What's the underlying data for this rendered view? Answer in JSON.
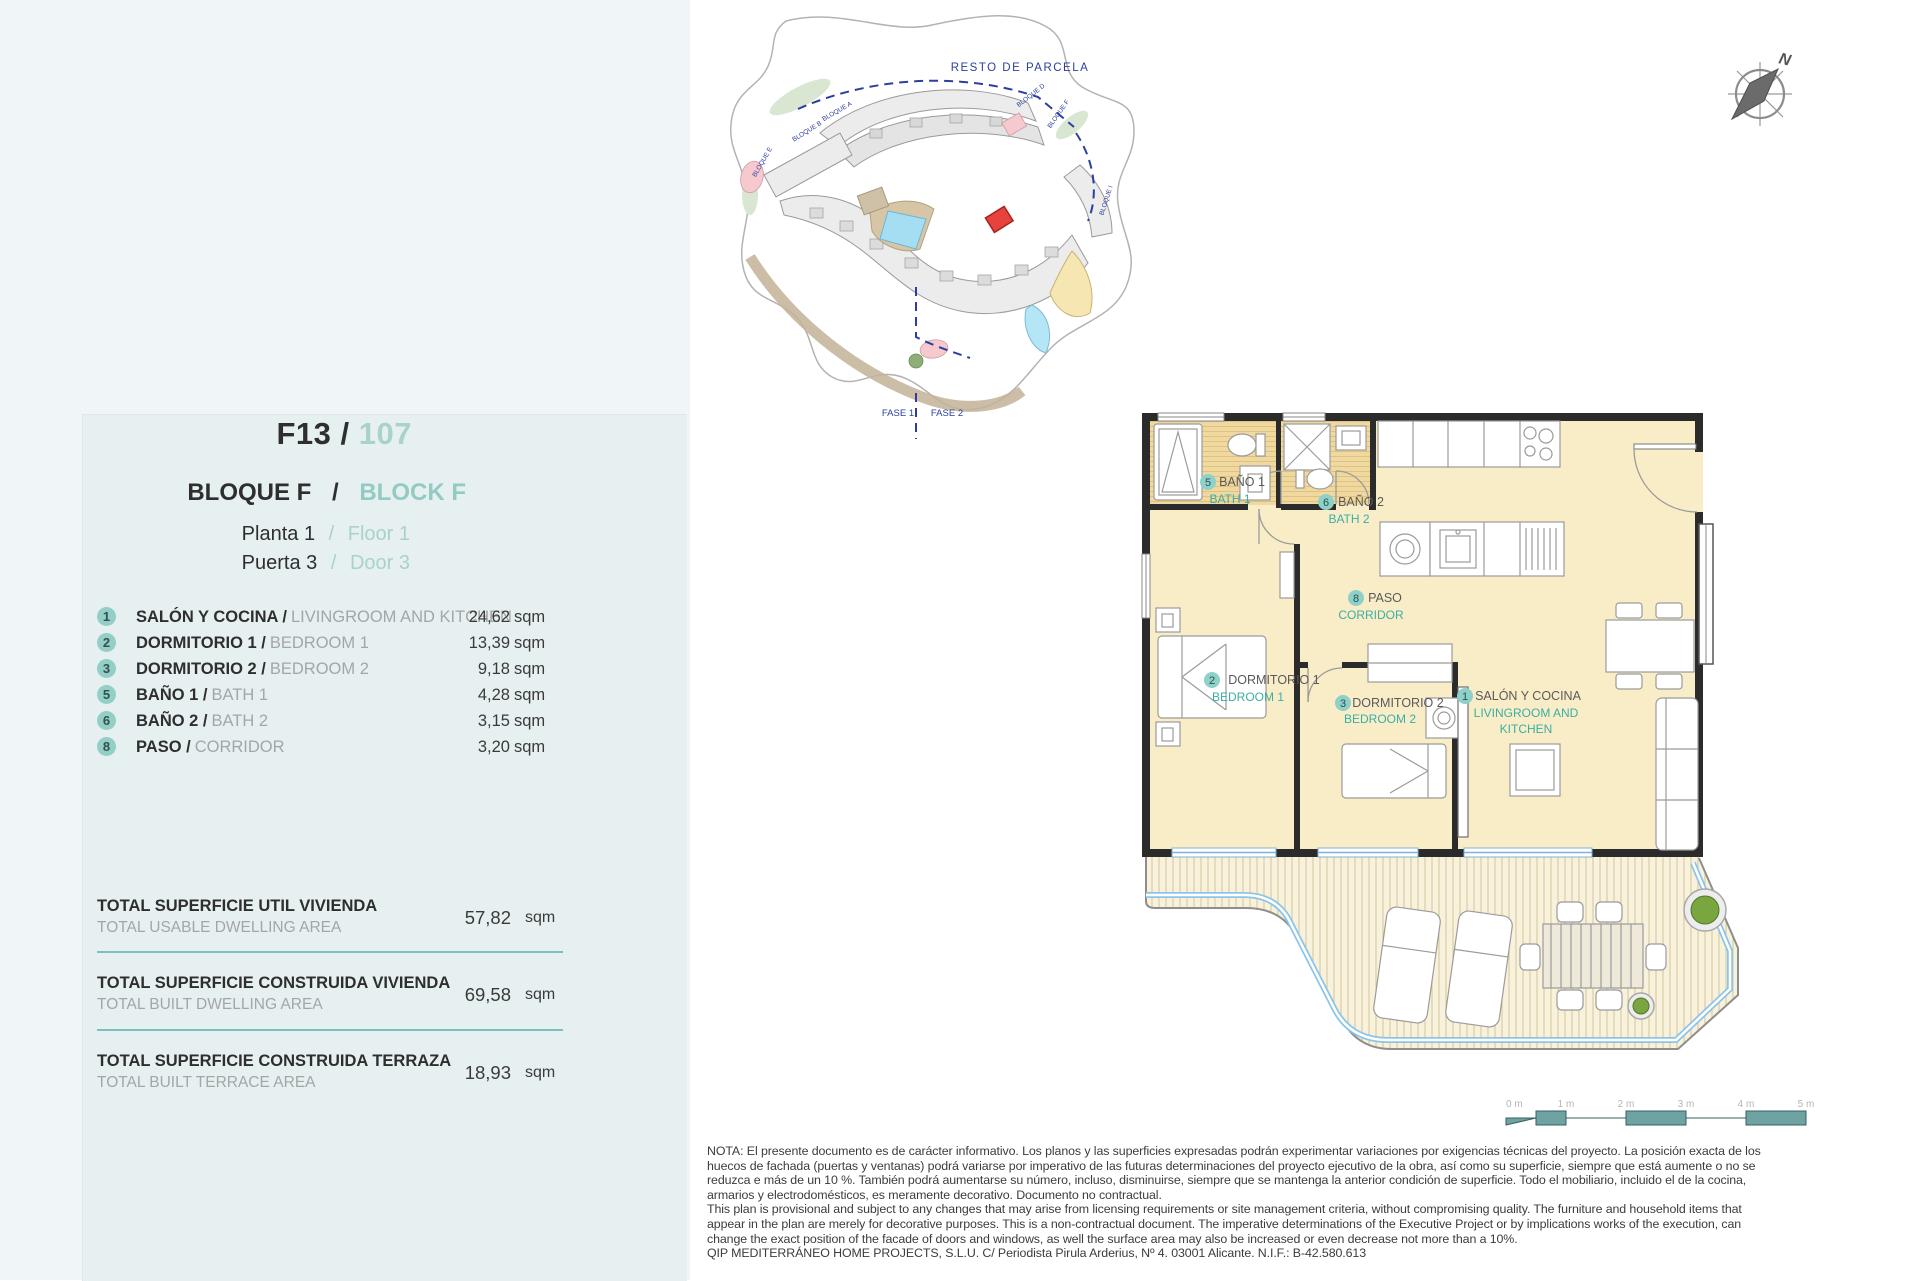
{
  "panel": {
    "unit_code": "F13 /",
    "unit_number": "107",
    "block_es": "BLOQUE F",
    "block_sep": "/",
    "block_en": "BLOCK F",
    "floor_es": "Planta 1",
    "floor_sep": "/",
    "floor_en": "Floor 1",
    "door_es": "Puerta 3",
    "door_sep": "/",
    "door_en": "Door 3"
  },
  "rooms": [
    {
      "num": "1",
      "name_es": "SALÓN Y COCINA /",
      "name_en": "LIVINGROOM AND KITCHEN",
      "area": "24,62",
      "unit": "sqm"
    },
    {
      "num": "2",
      "name_es": "DORMITORIO 1 /",
      "name_en": "BEDROOM 1",
      "area": "13,39",
      "unit": "sqm"
    },
    {
      "num": "3",
      "name_es": "DORMITORIO 2 /",
      "name_en": "BEDROOM 2",
      "area": "9,18",
      "unit": "sqm"
    },
    {
      "num": "5",
      "name_es": "BAÑO 1 /",
      "name_en": "BATH 1",
      "area": "4,28",
      "unit": "sqm"
    },
    {
      "num": "6",
      "name_es": "BAÑO 2 /",
      "name_en": "BATH 2",
      "area": "3,15",
      "unit": "sqm"
    },
    {
      "num": "8",
      "name_es": "PASO /",
      "name_en": "CORRIDOR",
      "area": "3,20",
      "unit": "sqm"
    }
  ],
  "totals": [
    {
      "label_es": "TOTAL SUPERFICIE UTIL VIVIENDA",
      "label_en": "TOTAL USABLE DWELLING AREA",
      "value": "57,82",
      "unit": "sqm"
    },
    {
      "label_es": "TOTAL SUPERFICIE CONSTRUIDA VIVIENDA",
      "label_en": "TOTAL BUILT DWELLING AREA",
      "value": "69,58",
      "unit": "sqm"
    },
    {
      "label_es": "TOTAL SUPERFICIE CONSTRUIDA TERRAZA",
      "label_en": "TOTAL BUILT TERRACE AREA",
      "value": "18,93",
      "unit": "sqm"
    }
  ],
  "floor_plan": {
    "labels": [
      {
        "num": "1",
        "es": "SALÓN Y COCINA",
        "en": "LIVINGROOM AND",
        "en2": "KITCHEN"
      },
      {
        "num": "2",
        "es": "DORMITORIO 1",
        "en": "BEDROOM 1"
      },
      {
        "num": "3",
        "es": "DORMITORIO 2",
        "en": "BEDROOM 2"
      },
      {
        "num": "5",
        "es": "BAÑO 1",
        "en": "BATH 1"
      },
      {
        "num": "6",
        "es": "BAÑO 2",
        "en": "BATH 2"
      },
      {
        "num": "8",
        "es": "PASO",
        "en": "CORRIDOR"
      }
    ]
  },
  "site_plan": {
    "resto_label": "RESTO DE PARCELA",
    "fase1": "FASE 1",
    "fase2": "FASE 2",
    "blocks": [
      "BLOQUE A",
      "BLOQUE B",
      "BLOQUE E",
      "BLOQUE D",
      "BLOQUE F",
      "BLOQUE I"
    ]
  },
  "compass": {
    "letter": "N"
  },
  "scale_bar": {
    "labels": [
      "0 m",
      "1 m",
      "2 m",
      "3 m",
      "4 m",
      "5 m"
    ]
  },
  "notes": {
    "lines": [
      "NOTA: El presente documento es de carácter informativo. Los planos y las superficies expresadas podrán experimentar variaciones por exigencias técnicas del proyecto. La posición exacta de los",
      "huecos de fachada (puertas y ventanas) podrá variarse por imperativo de las futuras determinaciones del proyecto ejecutivo de la obra, así como su superficie, siempre que está aumente o no se",
      "reduzca e más de un 10 %. También podrá aumentarse su número, incluso, disminuirse, siempre que se mantenga la anterior condición de superficie. Todo el mobiliario, incluido el de la cocina,",
      "armarios y electrodomésticos, es meramente decorativo. Documento no contractual.",
      "This plan is provisional and subject to any changes that may arise from licensing requirements or site management criteria, without compromising quality. The furniture and household items that",
      "appear in the plan are merely for decorative purposes. This is a non-contractual document. The imperative determinations of the Executive Project or by implications works of the execution, can",
      "change the exact position of the facade of doors and windows, as well the surface area may also be increased or even decrease not more than a 10%.",
      "QIP MEDITERRÁNEO HOME PROJECTS, S.L.U. C/ Periodista Pirula Arderius, Nº 4. 03001 Alicante. N.I.F.: B-42.580.613"
    ]
  },
  "colors": {
    "accent_teal": "#3aaea5",
    "light_teal": "#9ccfc8",
    "highlight_red": "#e8423c",
    "room_fill": "#f9edc8"
  }
}
